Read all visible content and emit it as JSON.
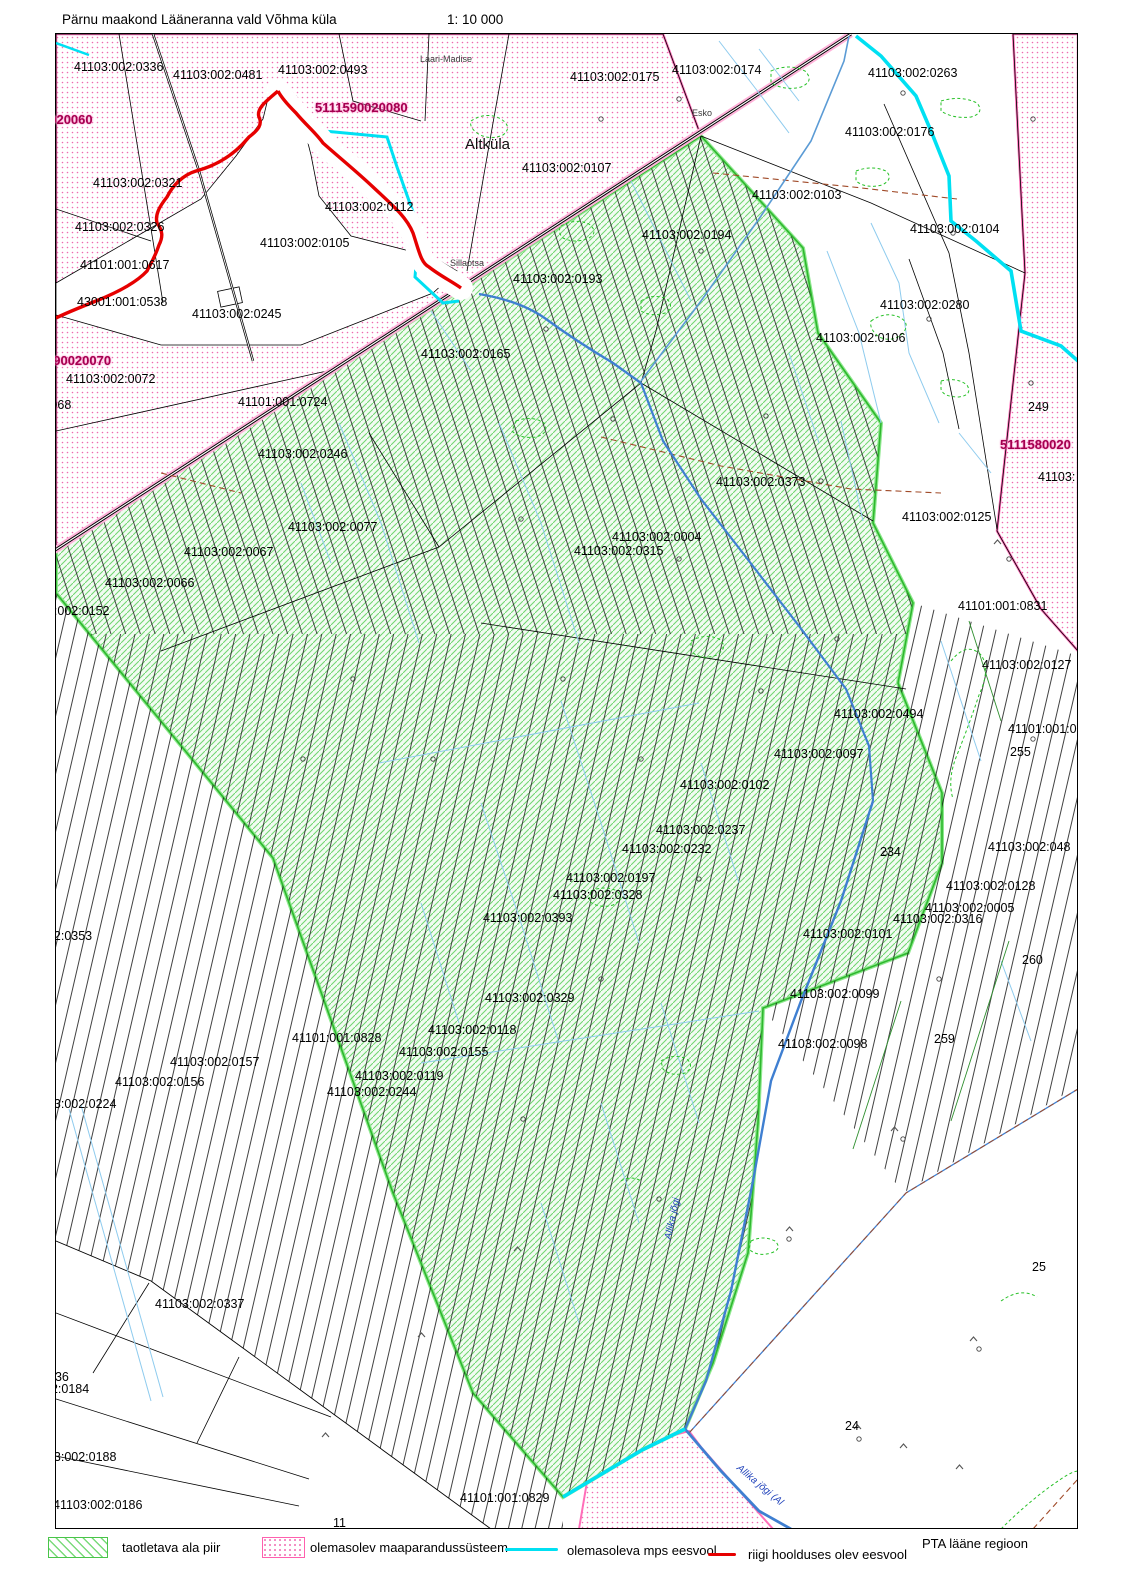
{
  "header": {
    "title": "Pärnu maakond Lääneranna vald Võhma küla",
    "scale": "1: 10 000"
  },
  "legend": {
    "items": [
      {
        "symbol": "green-hatch-swatch",
        "label": "taotletava ala piir"
      },
      {
        "symbol": "pink-dot-swatch",
        "label": "olemasolev maaparandussüsteem"
      },
      {
        "symbol": "cyan-line",
        "label": "olemasoleva mps eesvool"
      },
      {
        "symbol": "red-line",
        "label": "riigi hoolduses olev eesvool"
      }
    ],
    "region_note": "PTA lääne regioon"
  },
  "colors": {
    "applied_area_hatch": "#7ada7a",
    "applied_area_border": "#2eb82e",
    "drainage_system_dots": "#f06ab0",
    "mps_eesvool_cyan": "#00e0f2",
    "state_eesvool_red": "#e60000",
    "stream_blue": "#3f7fd1",
    "system_code_magenta": "#a3004f"
  },
  "map": {
    "labels": [
      {
        "text": "41103:002:0336",
        "x": 74,
        "y": 60,
        "cls": "p"
      },
      {
        "text": "41103:002:0481",
        "x": 173,
        "y": 68,
        "cls": "p"
      },
      {
        "text": "41103:002:0493",
        "x": 278,
        "y": 63,
        "cls": "p"
      },
      {
        "text": "41103:002:0175",
        "x": 570,
        "y": 70,
        "cls": "p"
      },
      {
        "text": "41103:002:0174",
        "x": 672,
        "y": 63,
        "cls": "p"
      },
      {
        "text": "41103:002:0263",
        "x": 868,
        "y": 66,
        "cls": "p"
      },
      {
        "text": "41103:002:0176",
        "x": 845,
        "y": 125,
        "cls": "p"
      },
      {
        "text": "41103:002:0107",
        "x": 522,
        "y": 161,
        "cls": "p"
      },
      {
        "text": "41103:002:0103",
        "x": 752,
        "y": 188,
        "cls": "p"
      },
      {
        "text": "41103:002:0321",
        "x": 93,
        "y": 176,
        "cls": "p"
      },
      {
        "text": "41103:002:0112",
        "x": 325,
        "y": 200,
        "cls": "p"
      },
      {
        "text": "22",
        "x": 40,
        "y": 193,
        "cls": "p"
      },
      {
        "text": "41103:002:0326",
        "x": 75,
        "y": 220,
        "cls": "p"
      },
      {
        "text": "41103:002:0105",
        "x": 260,
        "y": 236,
        "cls": "p"
      },
      {
        "text": "41103:002:0194",
        "x": 642,
        "y": 228,
        "cls": "p"
      },
      {
        "text": "41103:002:0104",
        "x": 910,
        "y": 222,
        "cls": "p"
      },
      {
        "text": "41101:001:0617",
        "x": 80,
        "y": 258,
        "cls": "p"
      },
      {
        "text": "43001:001:0538",
        "x": 77,
        "y": 295,
        "cls": "p"
      },
      {
        "text": "41103:002:0245",
        "x": 192,
        "y": 307,
        "cls": "p"
      },
      {
        "text": "41103:002:0193",
        "x": 513,
        "y": 272,
        "cls": "p"
      },
      {
        "text": "41103:002:0280",
        "x": 880,
        "y": 298,
        "cls": "p"
      },
      {
        "text": "41103:002:0106",
        "x": 816,
        "y": 331,
        "cls": "p"
      },
      {
        "text": "41103:002:0072",
        "x": 66,
        "y": 372,
        "cls": "p"
      },
      {
        "text": ":0068",
        "x": 40,
        "y": 398,
        "cls": "p"
      },
      {
        "text": "41103:002:0165",
        "x": 421,
        "y": 347,
        "cls": "p"
      },
      {
        "text": "41101:001:0724",
        "x": 238,
        "y": 395,
        "cls": "p"
      },
      {
        "text": "249",
        "x": 1028,
        "y": 400,
        "cls": "p"
      },
      {
        "text": "41103:002:0246",
        "x": 258,
        "y": 447,
        "cls": "p"
      },
      {
        "text": "41103:002:0373",
        "x": 716,
        "y": 475,
        "cls": "p"
      },
      {
        "text": "41103:",
        "x": 1038,
        "y": 470,
        "cls": "p"
      },
      {
        "text": "41103:002:0125",
        "x": 902,
        "y": 510,
        "cls": "p"
      },
      {
        "text": "41103:002:0077",
        "x": 288,
        "y": 520,
        "cls": "p"
      },
      {
        "text": "41103:002:0004",
        "x": 612,
        "y": 530,
        "cls": "p"
      },
      {
        "text": "41103:002:0315",
        "x": 574,
        "y": 544,
        "cls": "p"
      },
      {
        "text": "41103:002:0067",
        "x": 184,
        "y": 545,
        "cls": "p"
      },
      {
        "text": "41103:002:0066",
        "x": 105,
        "y": 576,
        "cls": "p"
      },
      {
        "text": "03:002:0152",
        "x": 40,
        "y": 604,
        "cls": "p"
      },
      {
        "text": "41101:001:0831",
        "x": 958,
        "y": 599,
        "cls": "p"
      },
      {
        "text": "41103:002:0127",
        "x": 982,
        "y": 658,
        "cls": "p"
      },
      {
        "text": "41103:002:0494",
        "x": 834,
        "y": 707,
        "cls": "p"
      },
      {
        "text": "41101:001:0",
        "x": 1008,
        "y": 722,
        "cls": "p"
      },
      {
        "text": "255",
        "x": 1010,
        "y": 745,
        "cls": "p"
      },
      {
        "text": "41103:002:0097",
        "x": 774,
        "y": 747,
        "cls": "p"
      },
      {
        "text": "41103:002:0102",
        "x": 680,
        "y": 778,
        "cls": "p"
      },
      {
        "text": "41103:002:0237",
        "x": 656,
        "y": 823,
        "cls": "p"
      },
      {
        "text": "41103:002:0232",
        "x": 622,
        "y": 842,
        "cls": "p"
      },
      {
        "text": "234",
        "x": 880,
        "y": 845,
        "cls": "p"
      },
      {
        "text": "41103:002:048",
        "x": 988,
        "y": 840,
        "cls": "p"
      },
      {
        "text": "41103:002:0197",
        "x": 566,
        "y": 871,
        "cls": "p"
      },
      {
        "text": "41103:002:0328",
        "x": 553,
        "y": 888,
        "cls": "p"
      },
      {
        "text": "41103:002:0128",
        "x": 946,
        "y": 879,
        "cls": "p"
      },
      {
        "text": "41103:002:0005",
        "x": 925,
        "y": 901,
        "cls": "p"
      },
      {
        "text": "41103:002:0316",
        "x": 893,
        "y": 912,
        "cls": "p"
      },
      {
        "text": "41103:002:0393",
        "x": 483,
        "y": 911,
        "cls": "p"
      },
      {
        "text": "41103:002:0101",
        "x": 803,
        "y": 927,
        "cls": "p"
      },
      {
        "text": "002:0353",
        "x": 40,
        "y": 929,
        "cls": "p"
      },
      {
        "text": "260",
        "x": 1022,
        "y": 953,
        "cls": "p"
      },
      {
        "text": "41103:002:0329",
        "x": 485,
        "y": 991,
        "cls": "p"
      },
      {
        "text": "41103:002:0099",
        "x": 790,
        "y": 987,
        "cls": "p"
      },
      {
        "text": "41101:001:0828",
        "x": 292,
        "y": 1031,
        "cls": "p"
      },
      {
        "text": "41103:002:0118",
        "x": 428,
        "y": 1023,
        "cls": "p"
      },
      {
        "text": "41103:002:0155",
        "x": 399,
        "y": 1045,
        "cls": "p"
      },
      {
        "text": "41103:002:0098",
        "x": 778,
        "y": 1037,
        "cls": "p"
      },
      {
        "text": "259",
        "x": 934,
        "y": 1032,
        "cls": "p"
      },
      {
        "text": "41103:002:0157",
        "x": 170,
        "y": 1055,
        "cls": "p"
      },
      {
        "text": "41103:002:0119",
        "x": 355,
        "y": 1069,
        "cls": "p"
      },
      {
        "text": "41103:002:0156",
        "x": 115,
        "y": 1075,
        "cls": "p"
      },
      {
        "text": "41103:002:0244",
        "x": 327,
        "y": 1085,
        "cls": "p"
      },
      {
        "text": "103:002:0224",
        "x": 40,
        "y": 1097,
        "cls": "p"
      },
      {
        "text": "25",
        "x": 1032,
        "y": 1260,
        "cls": "p"
      },
      {
        "text": "79",
        "x": 40,
        "y": 1270,
        "cls": "p"
      },
      {
        "text": "41103:002:0337",
        "x": 155,
        "y": 1297,
        "cls": "p"
      },
      {
        "text": "236",
        "x": 48,
        "y": 1370,
        "cls": "p"
      },
      {
        "text": "02:0184",
        "x": 44,
        "y": 1382,
        "cls": "p"
      },
      {
        "text": "103:002:0188",
        "x": 40,
        "y": 1450,
        "cls": "p"
      },
      {
        "text": "41103:002:0186",
        "x": 53,
        "y": 1498,
        "cls": "p"
      },
      {
        "text": "41101:001:0829",
        "x": 460,
        "y": 1491,
        "cls": "p"
      },
      {
        "text": "24",
        "x": 845,
        "y": 1419,
        "cls": "p"
      },
      {
        "text": "11",
        "x": 333,
        "y": 1516,
        "cls": "p"
      },
      {
        "text": "0020060",
        "x": 42,
        "y": 113,
        "cls": "m"
      },
      {
        "text": "5111590020080",
        "x": 315,
        "y": 101,
        "cls": "m"
      },
      {
        "text": "590020070",
        "x": 46,
        "y": 354,
        "cls": "m"
      },
      {
        "text": "5111580020",
        "x": 1000,
        "y": 438,
        "cls": "m"
      },
      {
        "text": "Laari-Madise",
        "x": 420,
        "y": 52,
        "cls": "t"
      },
      {
        "text": "Esko",
        "x": 692,
        "y": 106,
        "cls": "t"
      },
      {
        "text": "Sillaotsa",
        "x": 450,
        "y": 256,
        "cls": "t"
      },
      {
        "text": "Altküla",
        "x": 465,
        "y": 138,
        "cls": "v"
      },
      {
        "text": "Allika jõgi",
        "x": 662,
        "y": 1238,
        "cls": "w",
        "rot": -78
      },
      {
        "text": "Allika jõgi (Al",
        "x": 742,
        "y": 1462,
        "cls": "w",
        "rot": 40
      }
    ]
  }
}
